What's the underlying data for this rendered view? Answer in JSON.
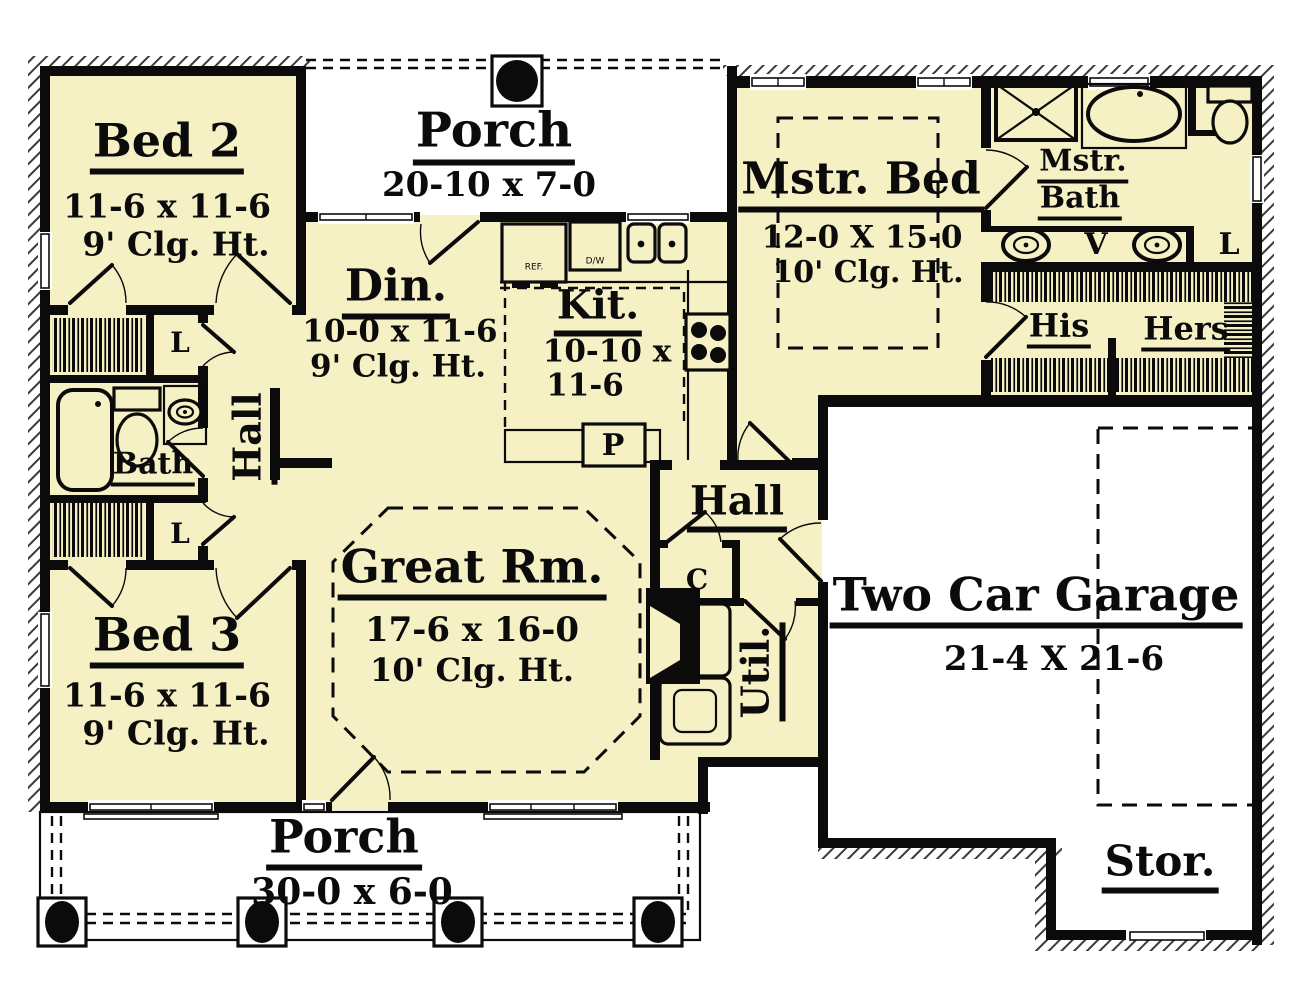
{
  "title": "House Floor Plan",
  "colors": {
    "floor": "#f6f1c5",
    "wall": "#0b0b0b",
    "paper": "#ffffff",
    "hatch": "#3a3a3a"
  },
  "rooms": {
    "bed2": {
      "name": "Bed 2",
      "dims": "11-6 x 11-6",
      "ceiling": "9' Clg. Ht."
    },
    "bed3": {
      "name": "Bed 3",
      "dims": "11-6 x 11-6",
      "ceiling": "9' Clg. Ht."
    },
    "porch_top": {
      "name": "Porch",
      "dims": "20-10 x 7-0"
    },
    "porch_bottom": {
      "name": "Porch",
      "dims": "30-0 x 6-0"
    },
    "mstr_bed": {
      "name": "Mstr. Bed",
      "dims": "12-0 X 15-0",
      "ceiling": "10' Clg. Ht."
    },
    "mstr_bath": {
      "line1": "Mstr.",
      "line2": "Bath"
    },
    "din": {
      "name": "Din.",
      "dims": "10-0 x 11-6",
      "ceiling": "9' Clg. Ht."
    },
    "kit": {
      "name": "Kit.",
      "dims_line1": "10-10 x",
      "dims_line2": "11-6"
    },
    "great": {
      "name": "Great Rm.",
      "dims": "17-6 x 16-0",
      "ceiling": "10' Clg. Ht."
    },
    "garage": {
      "name": "Two Car Garage",
      "dims": "21-4 X 21-6"
    },
    "stor": {
      "name": "Stor."
    },
    "hall_left": {
      "name": "Hall"
    },
    "hall_right": {
      "name": "Hall"
    },
    "util": {
      "name": "Util."
    },
    "bath": {
      "name": "Bath"
    }
  },
  "closets": {
    "his": "His",
    "hers": "Hers",
    "linen_top": "L",
    "linen_bottom": "L",
    "linen_master": "L",
    "coat": "C",
    "pantry": "P",
    "vanity": "V"
  },
  "appliances": {
    "fridge": "REF.",
    "dishwasher": "D/W"
  },
  "fixture_icons": [
    "shower-icon",
    "garden-tub-icon",
    "toilet-icon",
    "vanity-sink-icon",
    "double-sink-icon",
    "bathtub-icon",
    "refrigerator-icon",
    "dishwasher-icon",
    "kitchen-sink-icon",
    "range-icon",
    "washer-dryer-icon",
    "fireplace-icon",
    "porch-column-icon",
    "closet-rod-icon"
  ]
}
